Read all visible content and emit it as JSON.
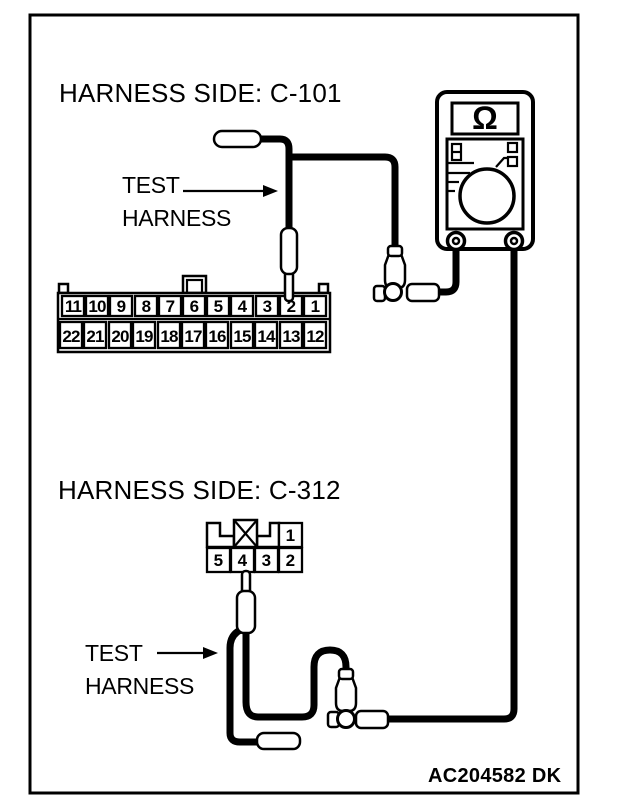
{
  "figure": {
    "code": "AC204582 DK"
  },
  "colors": {
    "ink": "#000000",
    "paper": "#ffffff"
  },
  "top_section": {
    "title": "HARNESS SIDE: C-101",
    "callout": {
      "line1": "TEST",
      "line2": "HARNESS"
    },
    "connector": {
      "id": "C-101",
      "top_row_pins": [
        "11",
        "10",
        "9",
        "8",
        "7",
        "6",
        "5",
        "4",
        "3",
        "2",
        "1"
      ],
      "bottom_row_pins": [
        "22",
        "21",
        "20",
        "19",
        "18",
        "17",
        "16",
        "15",
        "14",
        "13",
        "12"
      ],
      "probed_pin": "2"
    }
  },
  "bottom_section": {
    "title": "HARNESS SIDE: C-312",
    "callout": {
      "line1": "TEST",
      "line2": "HARNESS"
    },
    "connector": {
      "id": "C-312",
      "top_row_pins": [
        "1"
      ],
      "bottom_row_pins": [
        "5",
        "4",
        "3",
        "2"
      ],
      "probed_pin": "4"
    }
  },
  "meter": {
    "display_symbol": "Ω"
  }
}
